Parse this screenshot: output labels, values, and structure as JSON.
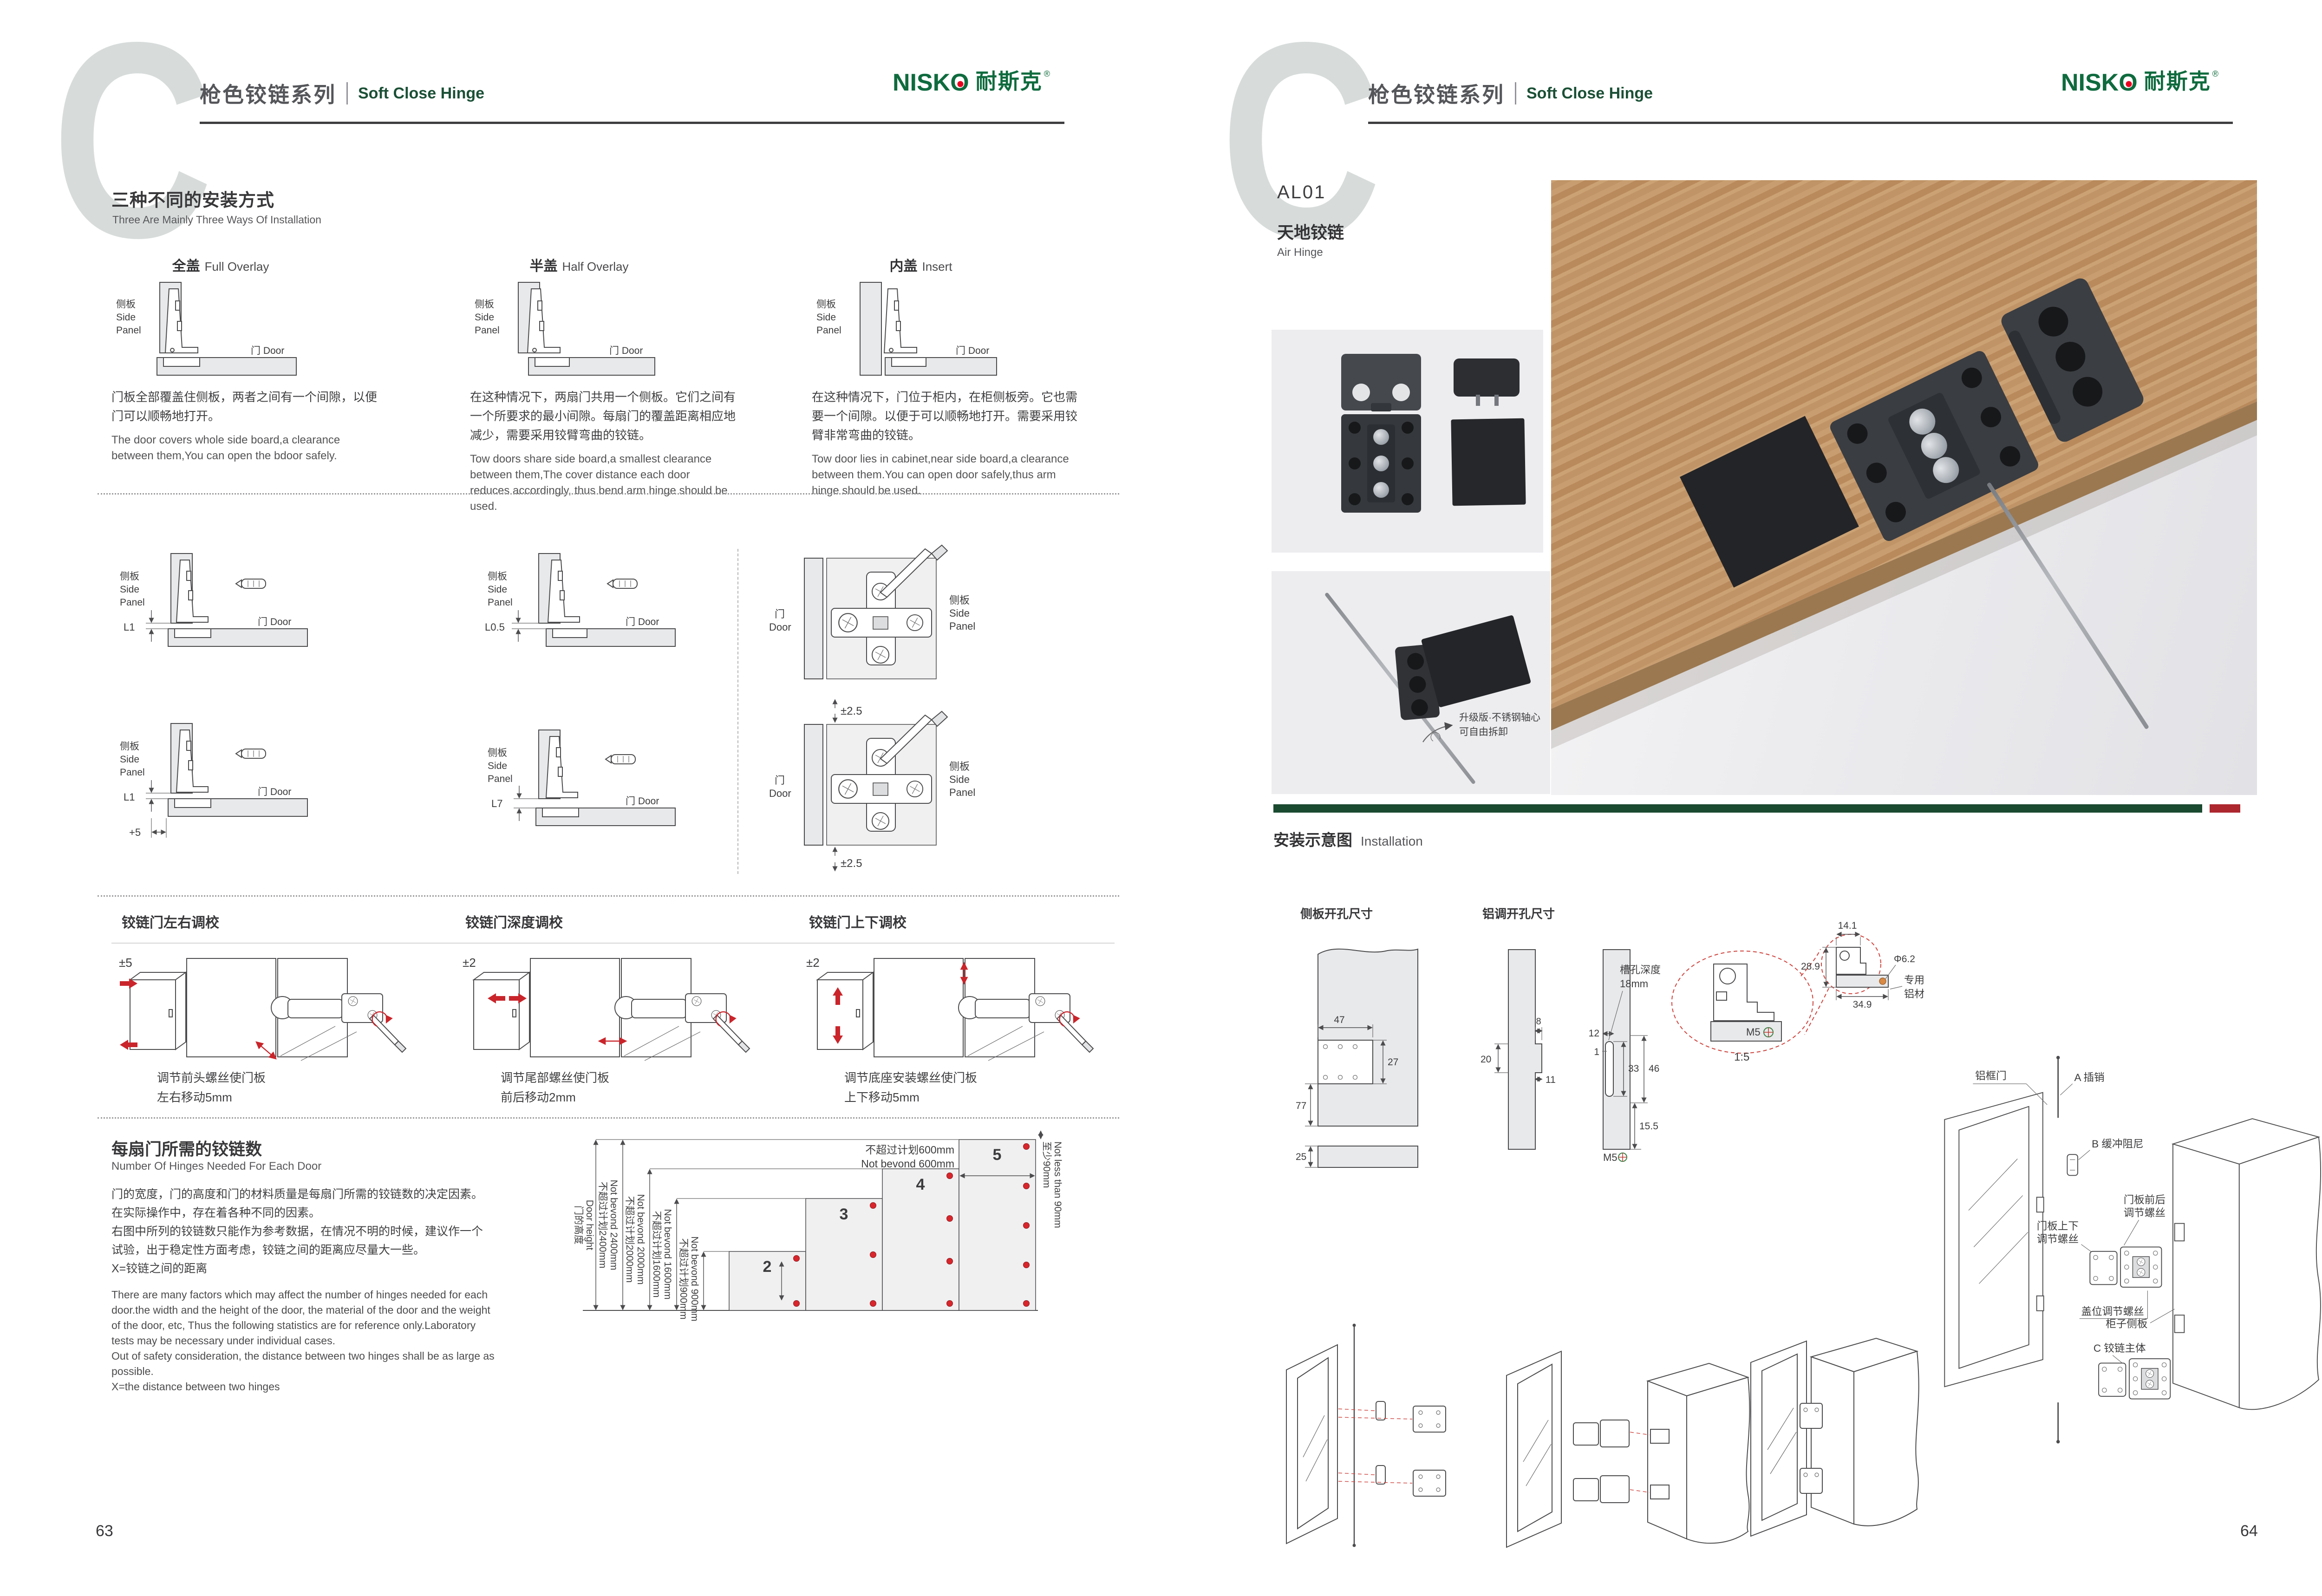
{
  "brand": {
    "logo_main": "NISK",
    "logo_o": "O",
    "logo_reg": "®",
    "logo_cn": "耐斯克",
    "mark_letter": "C"
  },
  "header": {
    "series_cn": "枪色铰链系列",
    "series_en": "Soft Close Hinge"
  },
  "common": {
    "side_cn": "侧板",
    "side_en1": "Side",
    "side_en2": "Panel",
    "door_full": "门 Door",
    "door_cn": "门",
    "door_en": "Door"
  },
  "pageL": {
    "num": "63",
    "sec1": {
      "title_cn": "三种不同的安装方式",
      "title_en": "Three Are Mainly Three Ways Of Installation",
      "m": [
        {
          "cn": "全盖",
          "en": "Full Overlay",
          "p_cn": "门板全部覆盖住侧板，两者之间有一个间隙，以便门可以顺畅地打开。",
          "p_en": "The door covers whole side board,a clearance between them,You can open the bdoor safely."
        },
        {
          "cn": "半盖",
          "en": "Half Overlay",
          "p_cn": "在这种情况下，两扇门共用一个侧板。它们之间有一个所要求的最小间隙。每扇门的覆盖距离相应地减少，需要采用铰臂弯曲的铰链。",
          "p_en": "Tow doors share side board,a smallest clearance between them,The cover distance each door reduces accordingly, thus bend arm hinge should be used."
        },
        {
          "cn": "内盖",
          "en": "Insert",
          "p_cn": "在这种情况下，门位于柜内，在柜侧板旁。它也需要一个间隙。以便于可以顺畅地打开。需要采用铰臂非常弯曲的铰链。",
          "p_en": "Tow door lies in cabinet,near side board,a clearance between them.You can open door safely,thus arm hinge should be used."
        }
      ]
    },
    "sec2": {
      "dims": [
        "L1",
        "L0.5",
        "L1",
        "L7"
      ],
      "plus5": "+5",
      "pm": "±2.5"
    },
    "sec3": [
      {
        "title": "铰链门左右调校",
        "range": "±5",
        "cap1": "调节前头螺丝使门板",
        "cap2": "左右移动5mm"
      },
      {
        "title": "铰链门深度调校",
        "range": "±2",
        "cap1": "调节尾部螺丝使门板",
        "cap2": "前后移动2mm"
      },
      {
        "title": "铰链门上下调校",
        "range": "±2",
        "cap1": "调节底座安装螺丝使门板",
        "cap2": "上下移动5mm"
      }
    ],
    "sec4": {
      "title_cn": "每扇门所需的铰链数",
      "title_en": "Number Of Hinges Needed For Each Door",
      "cn": [
        "门的宽度，门的高度和门的材料质量是每扇门所需的铰链数的决定因素。",
        "在实际操作中，存在着各种不同的因素。",
        "右图中所列的铰链数只能作为参考数据，在情况不明的时候，建议作一个",
        "试验，出于稳定性方面考虑，铰链之间的距离应尽量大一些。",
        "X=铰链之间的距离"
      ],
      "en": [
        "There are many factors which may affect the number of hinges needed for each",
        "door.the width and the height of the door, the material of the door and the weight",
        "of the door, etc, Thus the following statistics are for reference only.Laboratory",
        "tests may be necessary under individual cases.",
        "Out of safety consideration, the distance between two hinges shall be as large as",
        "possible.",
        "X=the distance between two hinges"
      ]
    }
  },
  "chart": {
    "dh_cn": "门的高度",
    "dh_en": "Door height",
    "h2400_cn": "不超过计划2400mm",
    "h2400_en": "Not bevond 2400mm",
    "h2000_cn": "不超过计划2000mm",
    "h2000_en": "Not bevond 2000mm",
    "h1600_cn": "不超过计划1600mm",
    "h1600_en": "Not bevond 1600mm",
    "h900_cn": "不超过计划900mm",
    "h900_en": "Not bevond 900mm",
    "w600_cn": "不超过计划600mm",
    "w600_en": "Not bevond 600mm",
    "min90_cn": "至少90mm",
    "min90_en": "Not less than 90mm",
    "n": [
      "2",
      "3",
      "4",
      "5"
    ]
  },
  "chart_data": {
    "type": "bar",
    "title": "每扇门所需的铰链数 Number Of Hinges Needed For Each Door",
    "categories": [
      "不超过900mm",
      "不超过1600mm",
      "不超过2000mm",
      "不超过2400mm"
    ],
    "values": [
      2,
      3,
      4,
      5
    ],
    "xlabel": "门的高度 Door height",
    "ylabel": "每扇门所需铰链数",
    "annotations": [
      "门宽不超过计划600mm Not bevond 600mm",
      "铰链离门端至少90mm Not less than 90mm",
      "X=铰链之间的距离 X=the distance between two hinges"
    ]
  },
  "pageR": {
    "num": "64",
    "model": "AL01",
    "name_cn": "天地铰链",
    "name_en": "Air Hinge",
    "note1": "升级版·不锈钢轴心",
    "note2": "可自由拆卸",
    "install_cn": "安装示意图",
    "install_en": "Installation",
    "d1": {
      "title": "侧板开孔尺寸",
      "v47": "47",
      "v27": "27",
      "v77": "77",
      "v25": "25"
    },
    "d2": {
      "title": "铝调开孔尺寸",
      "v8": "8",
      "v20": "20",
      "v11": "11",
      "v12": "12",
      "v1": "1",
      "slot1": "槽孔深度",
      "slot2": "18mm",
      "v33": "33",
      "v46": "46",
      "v155": "15.5",
      "m5": "M5"
    },
    "det": {
      "v141": "14.1",
      "v289": "28.9",
      "dia": "Φ6.2",
      "v349": "34.9",
      "alu1": "专用",
      "alu2": "铝材",
      "scale": "1:5",
      "m5": "M5"
    },
    "ex": {
      "door": "铝框门",
      "a": "A 插销",
      "b": "B 缓冲阻尼",
      "fb1": "门板前后",
      "fb2": "调节螺丝",
      "ud1": "门板上下",
      "ud2": "调节螺丝",
      "cover": "盖位调节螺丝",
      "cab": "柜子侧板",
      "c": "C 铰链主体"
    }
  }
}
